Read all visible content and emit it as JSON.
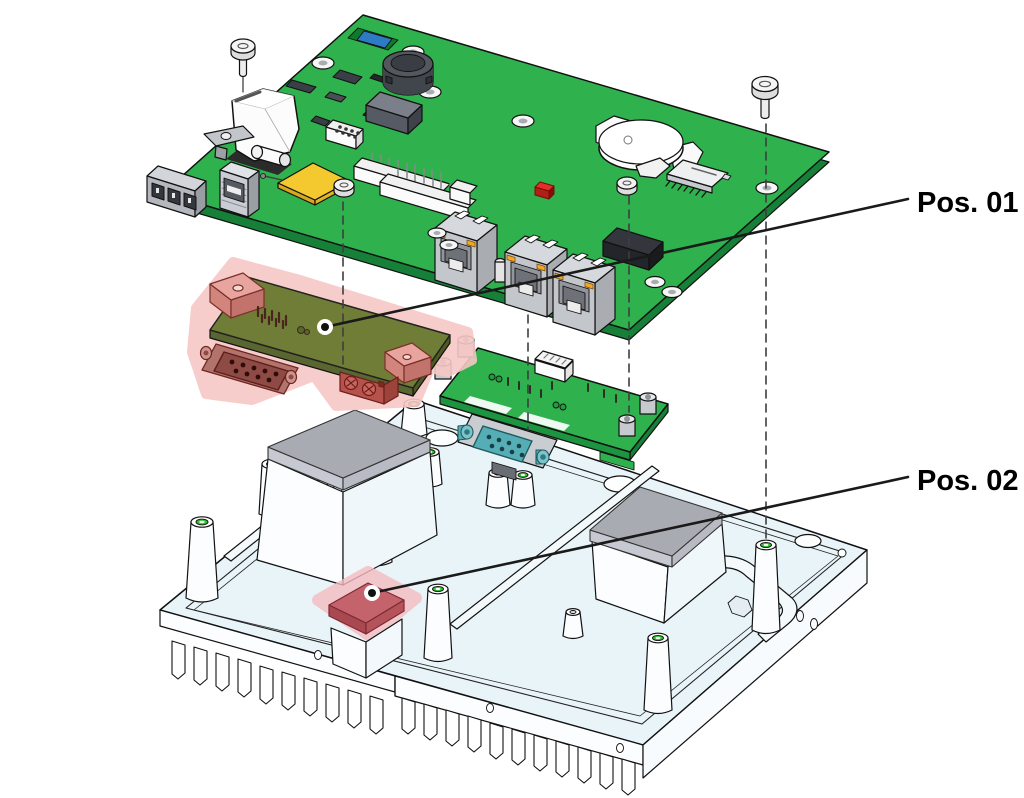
{
  "diagram": {
    "type": "exploded-assembly-view",
    "background": "#ffffff",
    "callouts": {
      "pos01": {
        "label": "Pos. 01",
        "target": "serial-interface-module",
        "marker": "dot-with-leader-line"
      },
      "pos02": {
        "label": "Pos. 02",
        "target": "thermal-pad-highlighted",
        "marker": "dot-with-leader-line"
      }
    },
    "colors": {
      "pcb_green": "#2FB14E",
      "pcb_edge_green": "#168038",
      "module_board_olive": "#707D37",
      "highlight_pink": "#F6C8C5",
      "highlight_pad_red": "#C4636B",
      "heatsink_body": "#E9F4F9",
      "thermal_pad_gray": "#A9ABB3",
      "connector_gray": "#C9CDD2",
      "db9_teal": "#55ADB5",
      "led_orange": "#F5A623",
      "led_red": "#E03028",
      "antenna_pad_yellow": "#F3C92F",
      "standoff_hole_green": "#2BC42B",
      "callout_line": "#1A1A1A"
    },
    "parts": [
      {
        "id": "carrier-board",
        "name": "carrier board PCB"
      },
      {
        "id": "serial-interface-module",
        "name": "serial interface module with D-Sub 9 (highlighted)",
        "callout": "Pos. 01"
      },
      {
        "id": "io-extension-module",
        "name": "I/O extension module with D-Sub 9"
      },
      {
        "id": "heatsink-chassis",
        "name": "finned heatsink base"
      },
      {
        "id": "thermal-pad-highlighted",
        "name": "thermal pad (highlighted)",
        "callout": "Pos. 02"
      },
      {
        "id": "thermal-pads-gray",
        "name": "gray thermal pads",
        "count": 2
      },
      {
        "id": "mounting-screws",
        "name": "mounting screws",
        "count": 4
      },
      {
        "id": "ethernet-ports",
        "name": "RJ45 Ethernet ports",
        "count": 3
      }
    ]
  }
}
